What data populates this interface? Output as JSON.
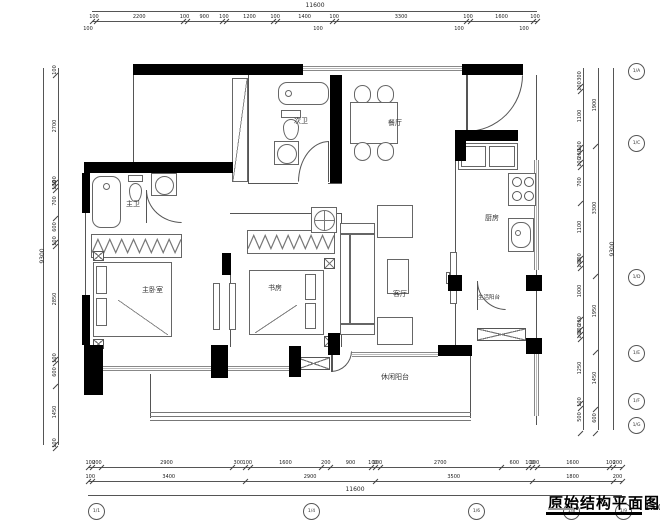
{
  "doc": {
    "title": "原始结构平面图",
    "scale": "1:50"
  },
  "rooms": {
    "second_bath": "次卫",
    "dining": "餐厅",
    "master_bath": "主卫",
    "master_bedroom": "主卧室",
    "study": "书房",
    "living": "客厅",
    "kitchen": "厨房",
    "service_balcony": "生活阳台",
    "leisure_balcony": "休闲阳台"
  },
  "dims": {
    "top": {
      "overall": "11600",
      "segments": [
        100,
        2200,
        100,
        900,
        100,
        1200,
        100,
        1400,
        100,
        3300,
        100,
        1600,
        100
      ],
      "sub": "100"
    },
    "bottom": {
      "overall": "11600",
      "row1": [
        100,
        200,
        2900,
        300,
        100,
        1600,
        200,
        900,
        100,
        100,
        2700,
        600,
        100,
        100,
        1600,
        100,
        200
      ],
      "row2": [
        100,
        3400,
        2900,
        3500,
        1800,
        200
      ]
    },
    "left": {
      "overall": "9300",
      "segments": [
        100,
        2700,
        100,
        100,
        700,
        600,
        100,
        2850,
        100,
        600,
        1450,
        100
      ]
    },
    "right": {
      "overall": "9300",
      "mid": [
        1900,
        3300,
        1950,
        1450,
        600
      ],
      "segments": [
        300,
        100,
        1100,
        100,
        200,
        100,
        700,
        1100,
        100,
        100,
        1000,
        200,
        100,
        100,
        1250,
        100,
        500
      ]
    }
  },
  "bubbles": {
    "bottom": [
      "1/1",
      "1/4",
      "1/6",
      "1/8",
      "1/9"
    ],
    "right": [
      "1/A",
      "1/C",
      "1/D",
      "1/E",
      "1/F",
      "1/G"
    ]
  }
}
